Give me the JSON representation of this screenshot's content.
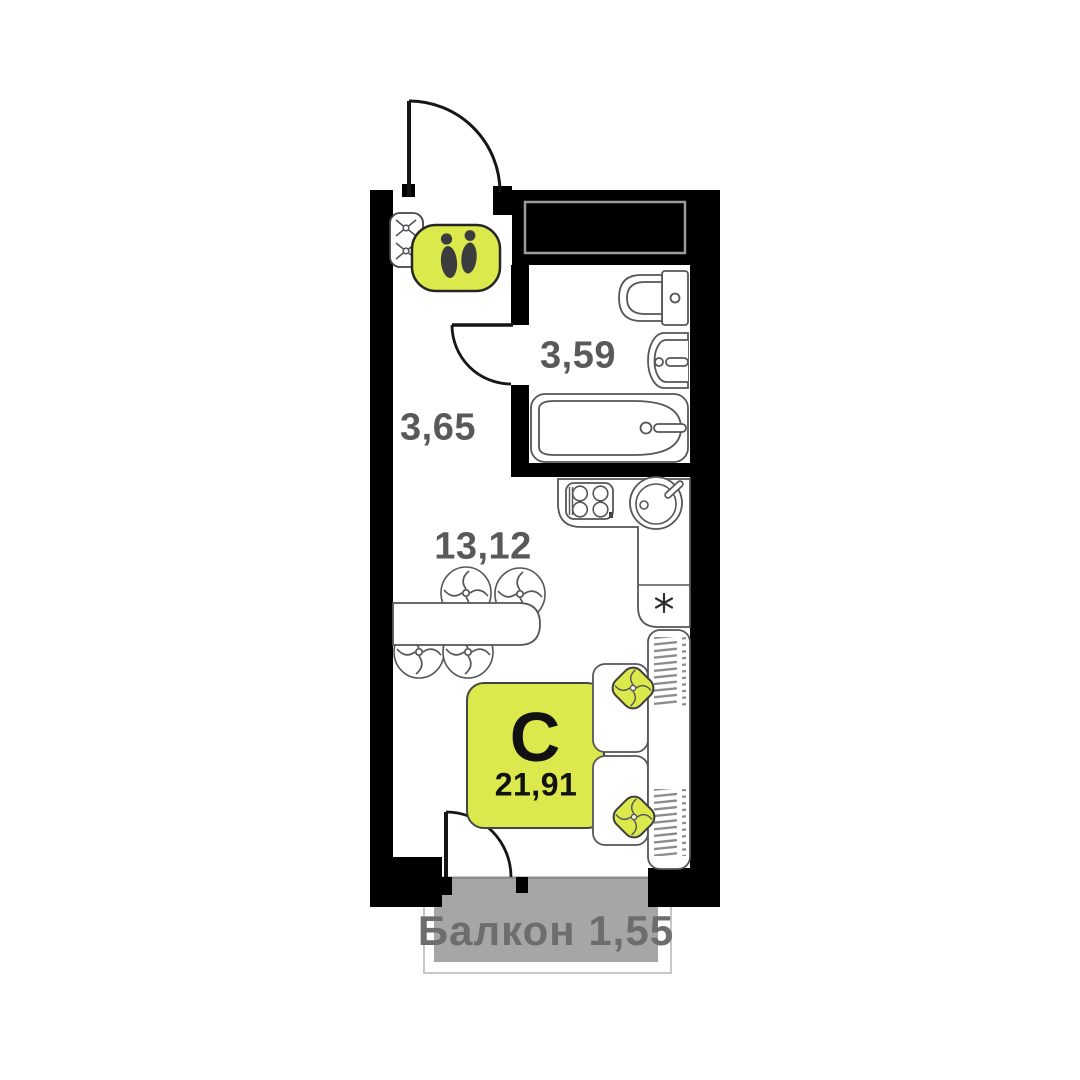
{
  "plan": {
    "type_letter": "С",
    "total_area": "21,91",
    "rooms": [
      {
        "name": "bathroom",
        "area": "3,59"
      },
      {
        "name": "hallway",
        "area": "3,65"
      },
      {
        "name": "living-kitchen",
        "area": "13,12"
      },
      {
        "name": "balcony",
        "area": "Балкон 1,55"
      }
    ]
  },
  "colors": {
    "accent_yellow": "#dbe94c",
    "wall_black": "#000000",
    "balcony_gray": "#a6a6a6",
    "fixture_outline": "#55565a",
    "area_label_gray": "#58595b",
    "balcony_text_gray": "#6d6d6d"
  },
  "icons": {
    "entrance_mat": "footprints-icon",
    "hall_hooks": "coat-hooks-icon",
    "fridge_mark": "snowflake-asterisk-icon",
    "wardrobe_fill": "hangers-hatch-pattern"
  }
}
